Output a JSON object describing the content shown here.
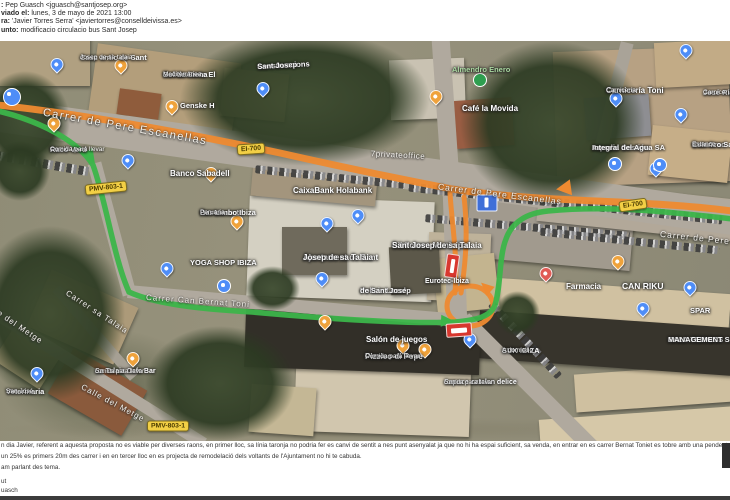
{
  "email": {
    "from_label": ":",
    "from_value": " Pep Guasch <jguasch@santjosep.org>",
    "sent_label": "viado el:",
    "sent_value": " lunes, 3 de mayo de 2021 13:00",
    "to_label": "ra:",
    "to_value": " 'Javier Torres Serra' <javiertorres@conselldeivissa.es>",
    "subject_label": "unto:",
    "subject_value": " modificacio circulacio bus Sant Josep"
  },
  "reply": {
    "line1": "n dia Javier, referent a aquesta proposta no es viable per diverses raons, en primer lloc, sa línia taronja no podria fer es canvi de sentit a nes punt asenyalat ja que no hi ha espai suficient, sa venda, en entrar en es carrer Bernat Toniet es tobre amb una pendent",
    "line2": "un 25% es primers 20m des carrer i en en tercer lloc en es projecta de remodelació dels voltants de l'Ajuntament no hi te cabuda.",
    "line3": "am parlant des tema.",
    "sig1": "ut",
    "sig2": "uasch"
  },
  "map": {
    "route_colors": {
      "orange": "#ee8a30",
      "green": "#3cb54a"
    },
    "shields": [
      {
        "text": "EI-700"
      },
      {
        "text": "EI-700"
      },
      {
        "text": "PMV-803-1"
      },
      {
        "text": "PMV-803-1"
      }
    ],
    "streets": [
      {
        "text": "Carrer de Pere Escanellas"
      },
      {
        "text": "Carrer de Pere Escanellas"
      },
      {
        "text": "Carrer de Pere E"
      },
      {
        "text": "Carrer Can Bernat Toni"
      },
      {
        "text": "Carrer sa Talaia"
      },
      {
        "text": "e del Metge"
      },
      {
        "text": "Calle del Metge"
      },
      {
        "text": "7privateoffice"
      }
    ],
    "places": [
      {
        "name": "Casc antic de Sant",
        "sub": "Josep de sa talaia"
      },
      {
        "name": "Restaurante El",
        "sub": "Sol de Siena",
        "sub2": "Mediterránea"
      },
      {
        "name": "Construccions",
        "sub": "Sant Josep"
      },
      {
        "name": "Genske H"
      },
      {
        "name": "Café la Movida"
      },
      {
        "name": "Almendro Enero"
      },
      {
        "name": "Carnicería Toni",
        "sub": "Carnicería"
      },
      {
        "name": "José Ribas Rib",
        "sub": "Carnicería"
      },
      {
        "name": "Aqualia Gestión",
        "sub": "Integral del Agua SA"
      },
      {
        "name": "Can Grao",
        "sub": "Estanco Sant Josep",
        "sub2": "Estanco"
      },
      {
        "name": "Racó Verd",
        "sub": "Comida para llevar"
      },
      {
        "name": "Banco Sabadell"
      },
      {
        "name": "Restaurante",
        "sub": "Bar Limbo Ibiza",
        "sub2": "Peruana"
      },
      {
        "name": "CaixaBank Holabank"
      },
      {
        "name": "YOGA SHOP IBIZA"
      },
      {
        "name": "Biblioteca Municipal",
        "sub": "Sant Josep de sa Talaia"
      },
      {
        "name": "Ajuntament de Sant",
        "sub": "Josep de sa Talaia"
      },
      {
        "name": "Policia Local",
        "sub": "de Sant Josep"
      },
      {
        "name": "Eurotec-Ibiza"
      },
      {
        "name": "Farmacia"
      },
      {
        "name": "CAN RIKU"
      },
      {
        "name": "Salón de juegos"
      },
      {
        "name": "Pizzico di Pepe",
        "sub": "Comida para llevar"
      },
      {
        "name": "Sapuce catalan delice",
        "sub": "comida para llevar"
      },
      {
        "name": "SUK IBIZA",
        "sub": "A domicilio"
      },
      {
        "name": "SALA TECNICS",
        "sub": "MANAGEMENT SLP"
      },
      {
        "name": "SPAR"
      },
      {
        "name": "Veterinaria",
        "sub": "San José"
      },
      {
        "name": "Sa Talaia Cafe Bar",
        "sub": "comida para llevar"
      }
    ]
  }
}
